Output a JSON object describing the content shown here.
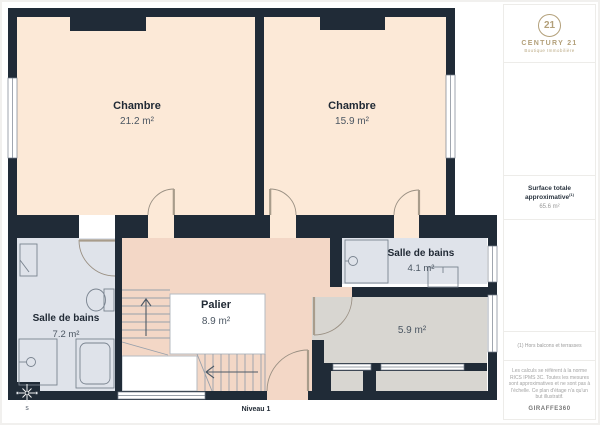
{
  "branding": {
    "logo_number": "21",
    "logo_name": "CENTURY 21",
    "logo_tagline": "Boutique Immobilière"
  },
  "sidebar": {
    "surface_label": "Surface totale approximative",
    "surface_superscript": "(1)",
    "surface_value": "65.6 m²",
    "note": "(1) Hors balcons et terrasses",
    "disclaimer": "Les calculs se réfèrent à la norme RICS IPMS 3C. Toutes les mesures sont approximatives et ne sont pas à l'échelle. Ce plan d'étage n'a qu'un but illustratif.",
    "provider": "GIRAFFE360"
  },
  "plan": {
    "level_label": "Niveau 1",
    "compass_letter": "S",
    "rooms": [
      {
        "name": "Chambre",
        "area": "21.2 m²"
      },
      {
        "name": "Chambre",
        "area": "15.9 m²"
      },
      {
        "name": "Salle de bains",
        "area": "7.2 m²"
      },
      {
        "name": "Palier",
        "area": "8.9 m²"
      },
      {
        "name": "Salle de bains",
        "area": "4.1 m²"
      },
      {
        "name": "",
        "area": "5.9 m²"
      }
    ],
    "colors": {
      "wall": "#202b37",
      "bedroom_floor": "#fce9d7",
      "landing_floor": "#f3d7c6",
      "bathroom_floor": "#dfe3ea",
      "room_floor": "#d8d6d1",
      "brand_gold": "#b3a07a"
    }
  }
}
